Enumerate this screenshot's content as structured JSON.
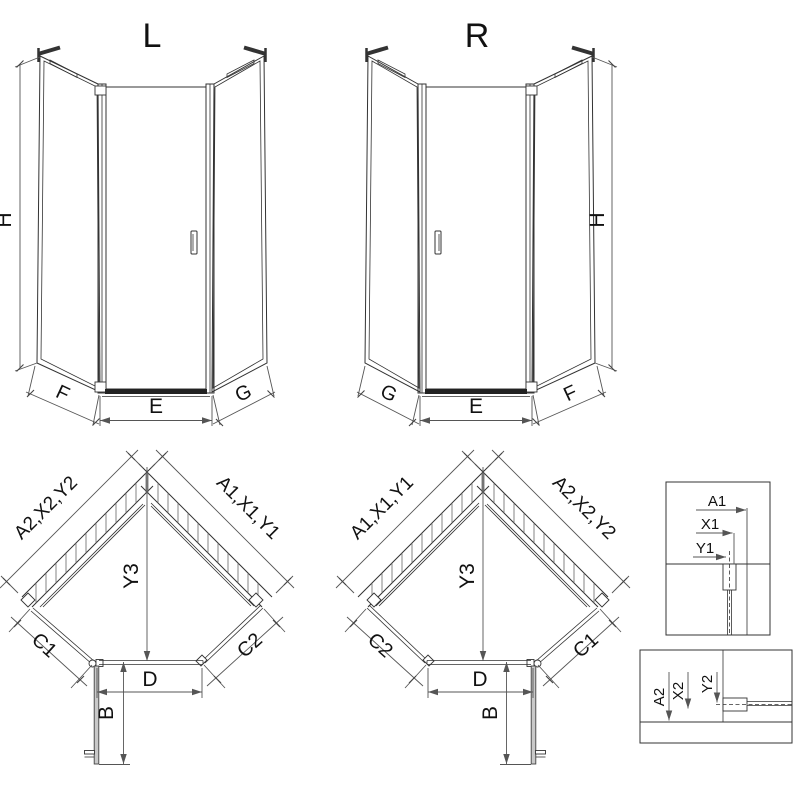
{
  "drawing": {
    "front_views": [
      {
        "variant": "L",
        "height_dim": "H",
        "bottom_left_dim": "F",
        "bottom_center_dim": "E",
        "bottom_right_dim": "G"
      },
      {
        "variant": "R",
        "height_dim": "H",
        "bottom_left_dim": "G",
        "bottom_center_dim": "E",
        "bottom_right_dim": "F"
      }
    ],
    "plan_views": [
      {
        "variant": "L",
        "wall_left_dim": "A2,X2,Y2",
        "wall_right_dim": "A1,X1,Y1",
        "depth_dim": "Y3",
        "front_left_dim": "C1",
        "front_right_dim": "C2",
        "door_width_dim": "D",
        "door_swing_dim": "B"
      },
      {
        "variant": "R",
        "wall_left_dim": "A1,X1,Y1",
        "wall_right_dim": "A2,X2,Y2",
        "depth_dim": "Y3",
        "front_left_dim": "C2",
        "front_right_dim": "C1",
        "door_width_dim": "D",
        "door_swing_dim": "B"
      }
    ],
    "detail_views": [
      {
        "position": "top-right",
        "a_dim": "A1",
        "x_dim": "X1",
        "y_dim": "Y1"
      },
      {
        "position": "bottom-right",
        "a_dim": "A2",
        "x_dim": "X2",
        "y_dim": "Y2"
      }
    ],
    "colors": {
      "line": "#333333",
      "dim_line": "#555555",
      "text": "#111111",
      "open_door_fill": "#c9c9c9",
      "background": "#ffffff"
    }
  }
}
